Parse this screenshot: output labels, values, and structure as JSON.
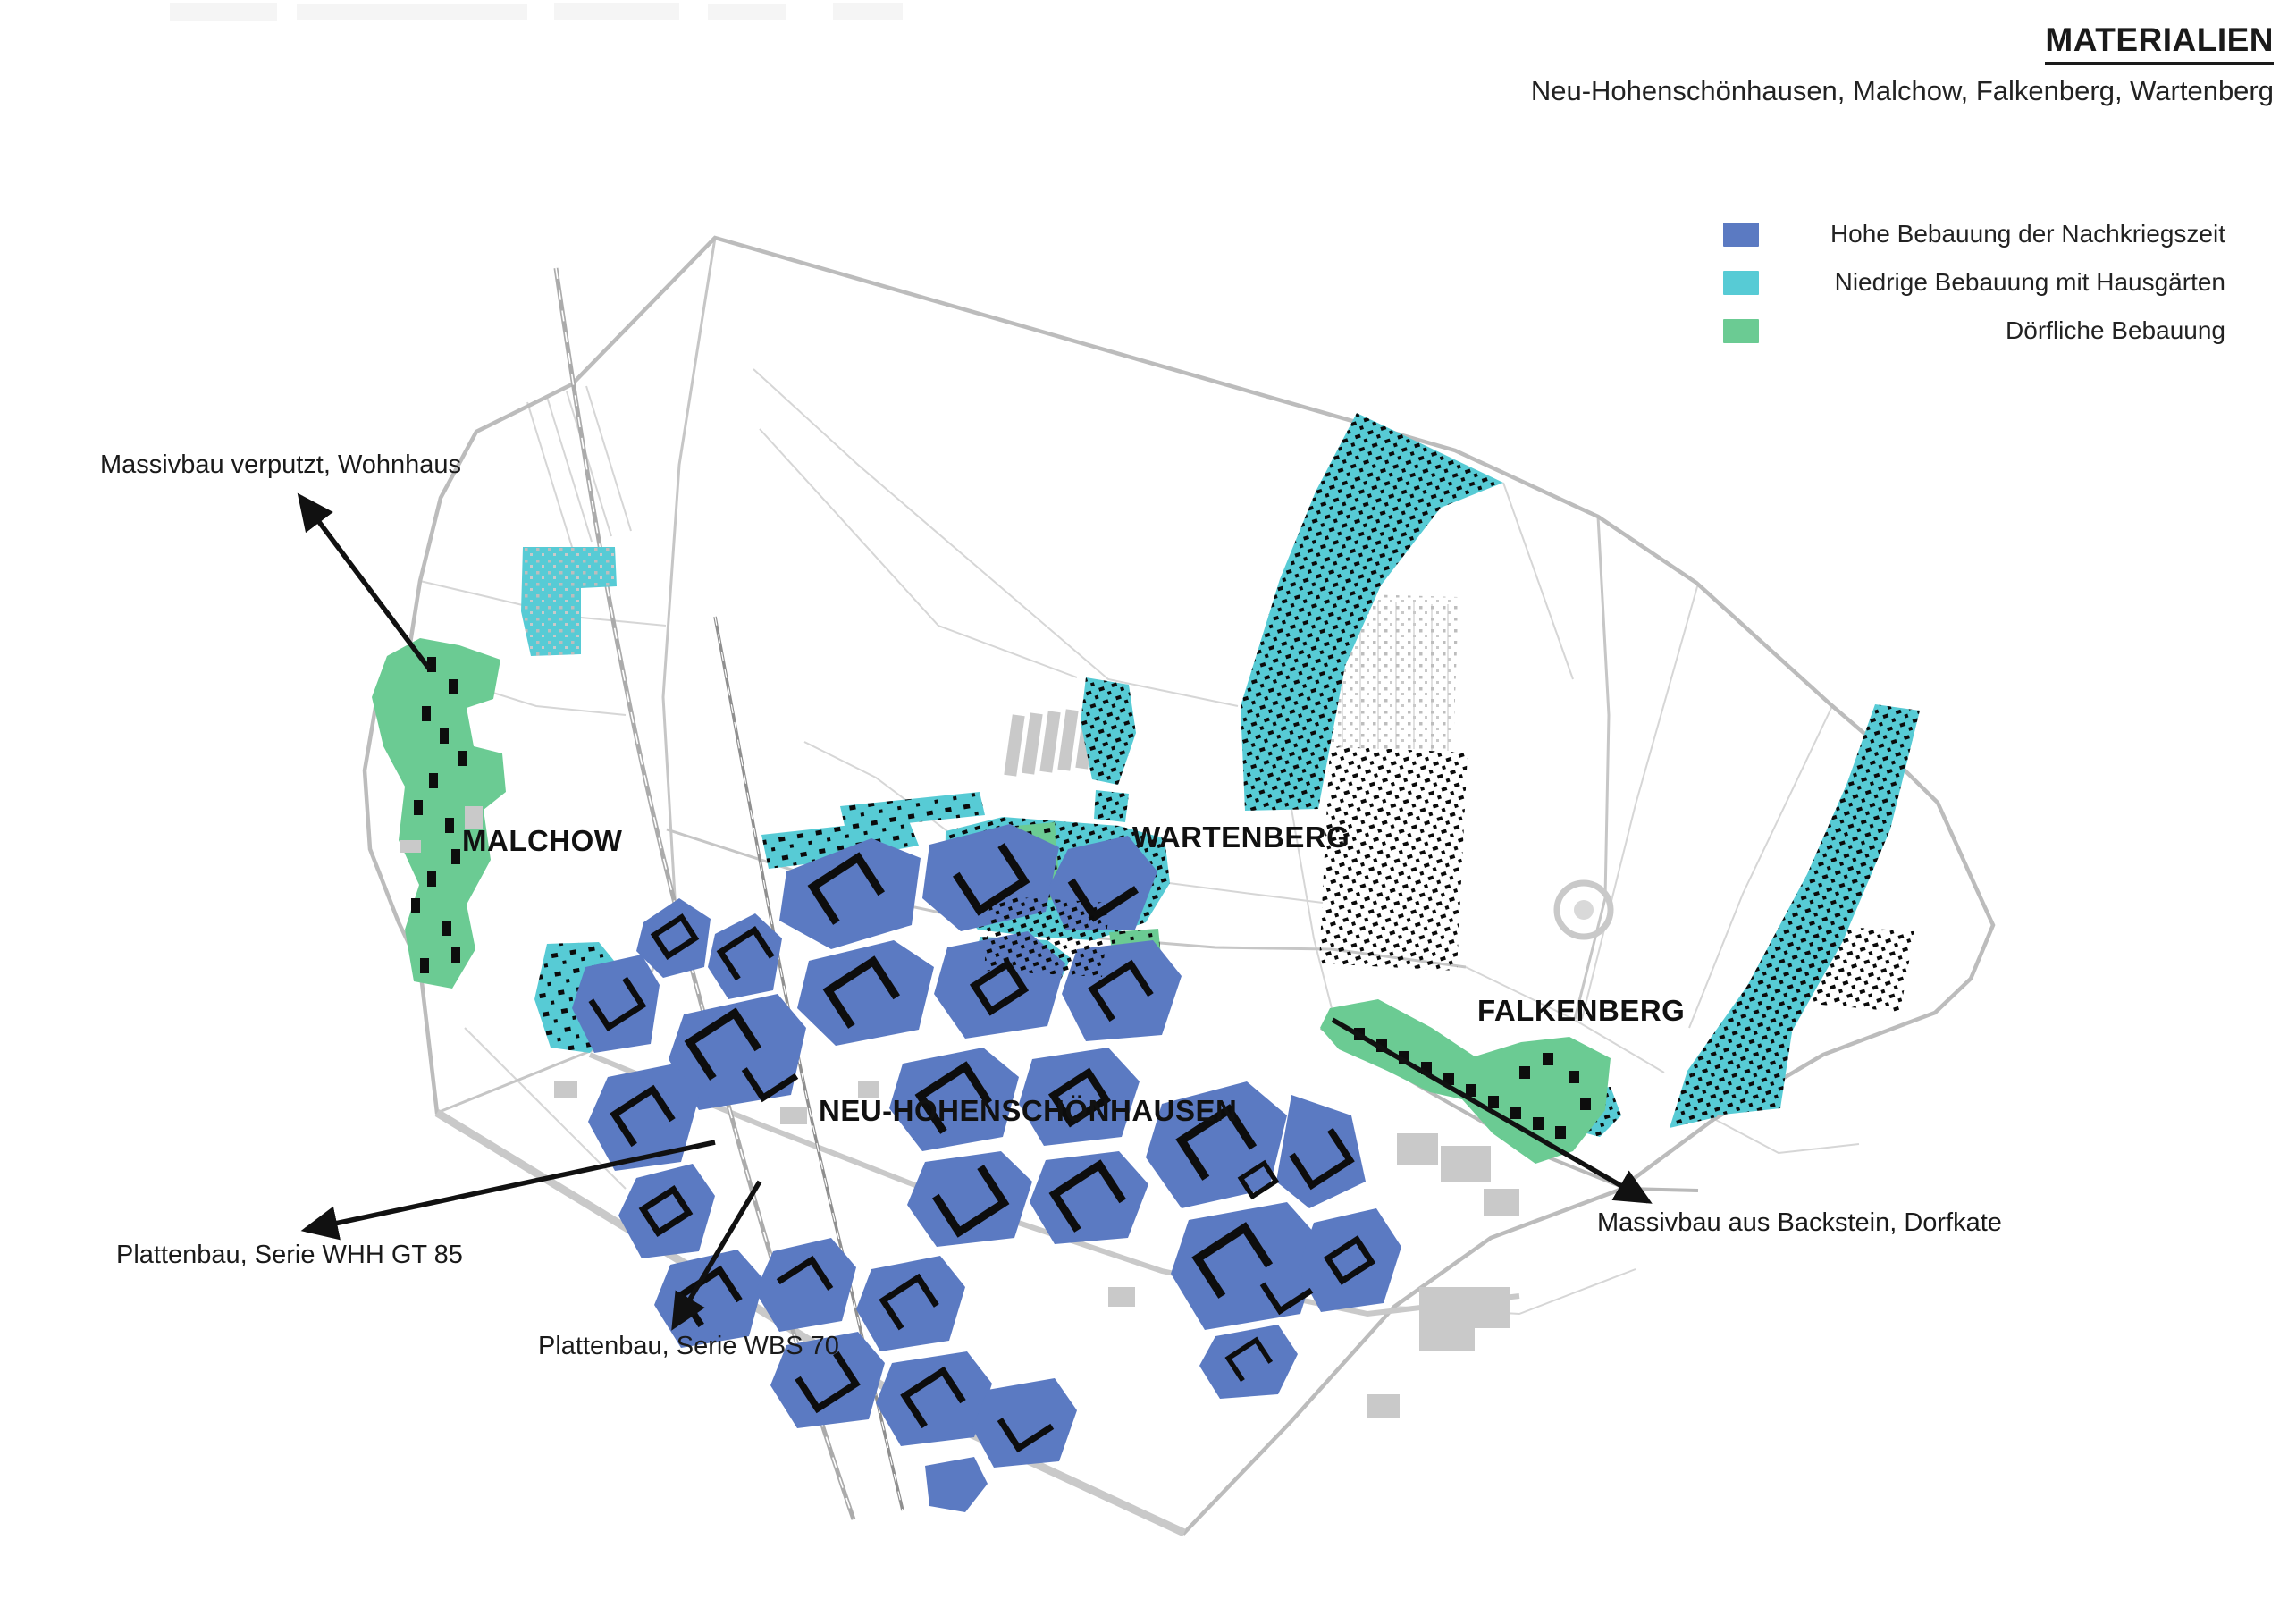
{
  "title_block": {
    "title": "MATERIALIEN",
    "subtitle": "Neu-Hohenschönhausen, Malchow, Falkenberg, Wartenberg"
  },
  "legend": {
    "items": [
      {
        "id": "hohe-bebauung",
        "label": "Hohe Bebauung der Nachkriegszeit",
        "color": "#5b7ac2"
      },
      {
        "id": "niedrige-bebauung",
        "label": "Niedrige Bebauung mit Hausgärten",
        "color": "#57cbd5"
      },
      {
        "id": "doerfliche-bebauung",
        "label": "Dörfliche Bebauung",
        "color": "#6bcb93"
      }
    ]
  },
  "map": {
    "districts": [
      {
        "label": "MALCHOW"
      },
      {
        "label": "WARTENBERG"
      },
      {
        "label": "NEU-HOHENSCHÖNHAUSEN"
      },
      {
        "label": "FALKENBERG"
      }
    ],
    "annotations": [
      {
        "label": "Massivbau verputzt, Wohnhaus"
      },
      {
        "label": "Plattenbau, Serie WHH GT 85"
      },
      {
        "label": "Plattenbau, Serie WBS 70"
      },
      {
        "label": "Massivbau aus Backstein, Dorfkate"
      }
    ],
    "colors": {
      "high_rise": "#5b7ac2",
      "low_rise": "#57cbd5",
      "village": "#6bcb93",
      "boundary": "#bcbcbc",
      "buildings": "#0d0d0d",
      "roads": "#d2d2d2",
      "railway": "#a6a6a6",
      "gray_buildings": "#c9c9c9"
    }
  }
}
